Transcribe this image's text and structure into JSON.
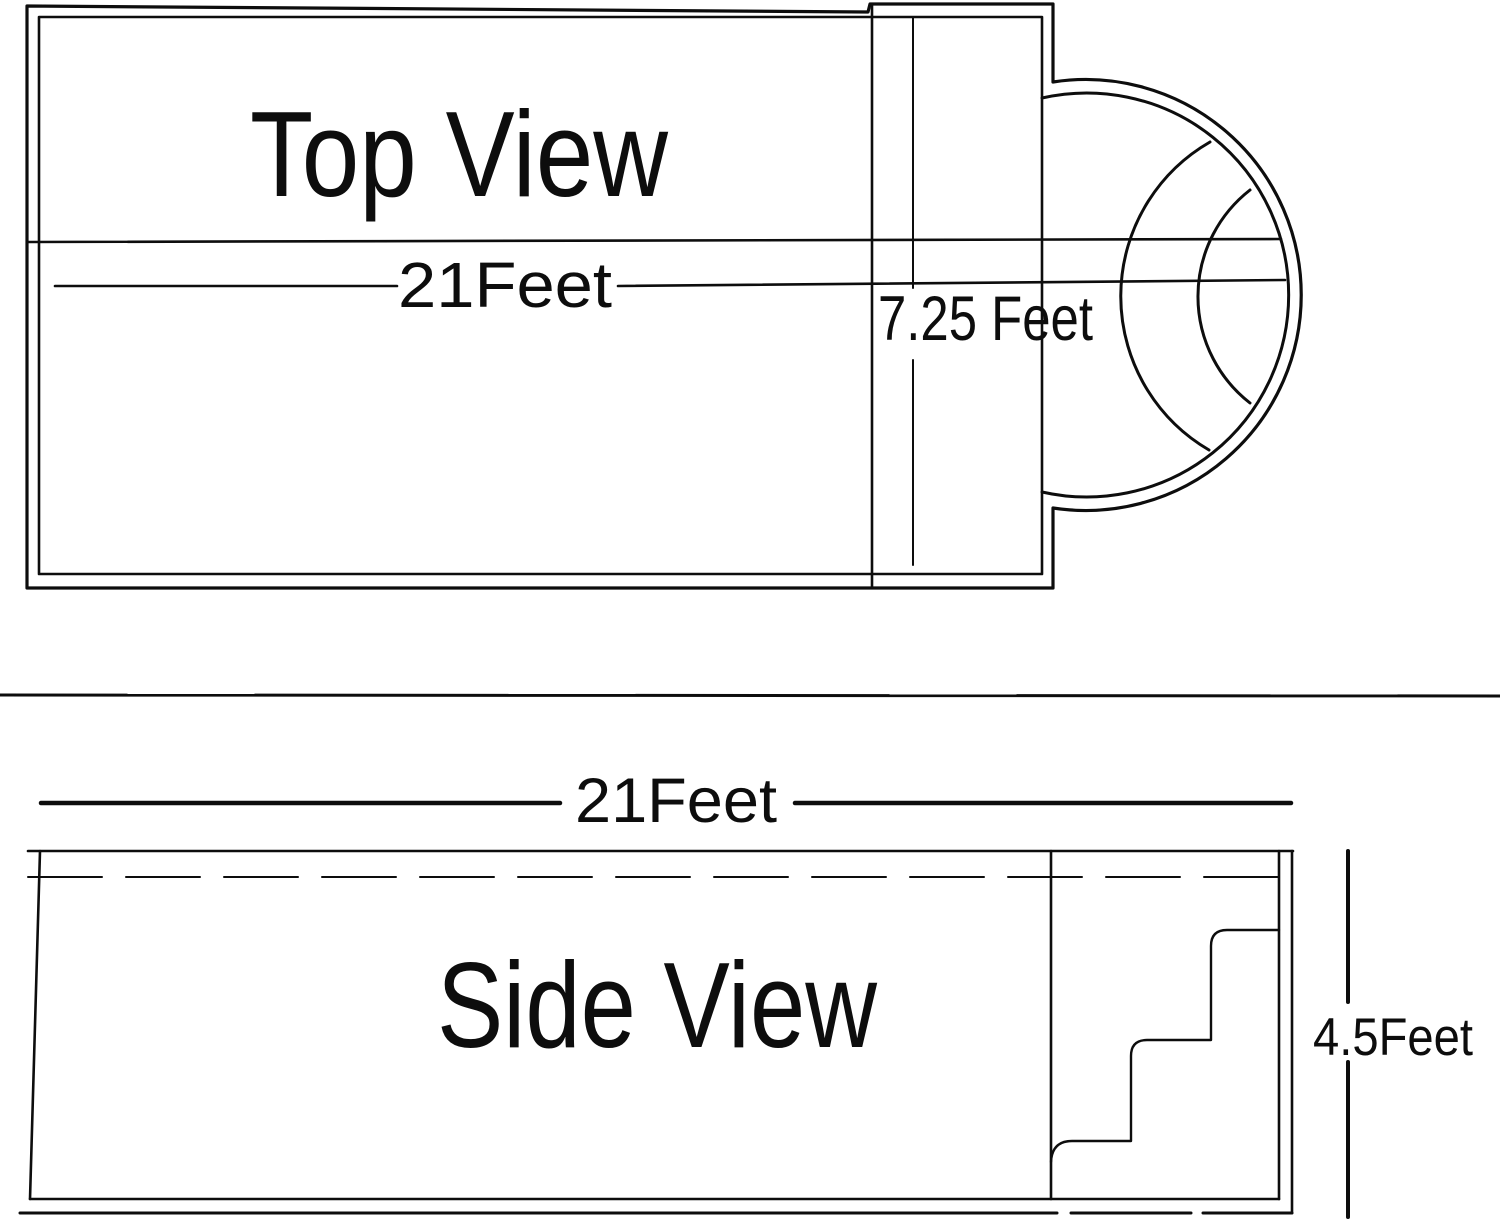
{
  "page": {
    "background_color": "#ffffff",
    "line_color": "#0d0d0d",
    "description": "Pool technical drawing with top view and side view"
  },
  "top_view": {
    "title": "Top View",
    "length_label": "21Feet",
    "step_width_label": "7.25 Feet"
  },
  "side_view": {
    "title": "Side View",
    "length_label": "21Feet",
    "depth_label": "4.5Feet"
  }
}
